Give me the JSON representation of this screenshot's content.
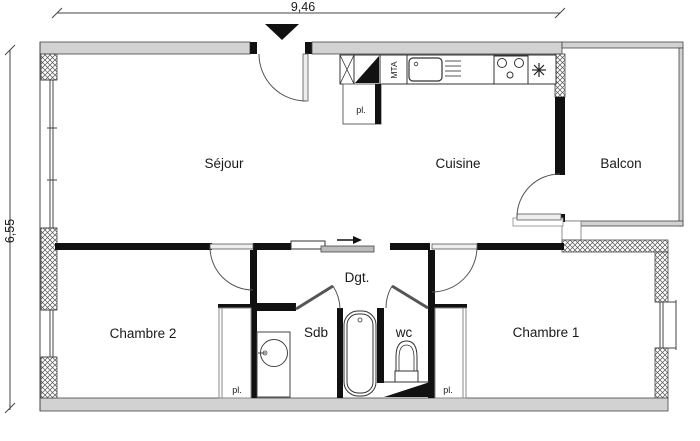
{
  "dimensions": {
    "top": "9,46",
    "left": "6,55"
  },
  "rooms": {
    "sejour": "Séjour",
    "cuisine": "Cuisine",
    "balcon": "Balcon",
    "hallway": "Dgt.",
    "bedroom2": "Chambre 2",
    "bathroom": "Sdb",
    "toilet": "wc",
    "bedroom1": "Chambre 1"
  },
  "closets": {
    "entry": "pl.",
    "bedroom2": "pl.",
    "bedroom1": "pl."
  },
  "technical": {
    "duct": "MTA"
  },
  "colors": {
    "wall_black": "#111111",
    "wall_gray": "#d2d2d2",
    "line": "#333333"
  }
}
